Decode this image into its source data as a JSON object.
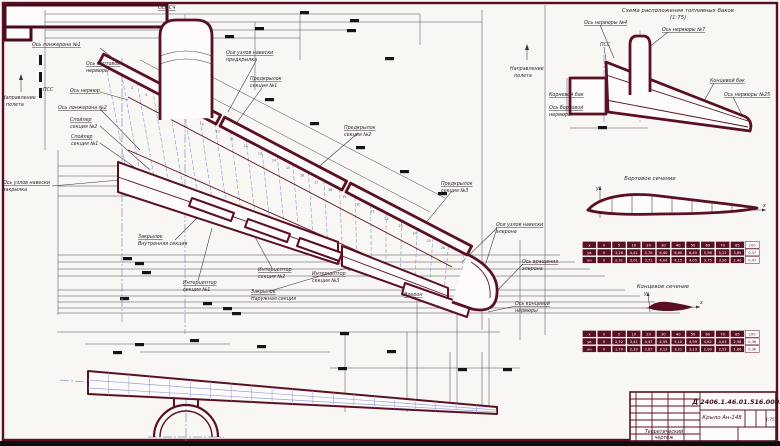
{
  "colors": {
    "line": "#5a1022",
    "ribs": "#9aa0d8",
    "dims": "#4a444a"
  },
  "plan": {
    "labels": {
      "os_sch": [
        "Ось СЧ"
      ],
      "napravlenie": [
        "Направление",
        "полета"
      ],
      "os_lonzherona_1": [
        "Ось лонжерона №1"
      ],
      "os_bortovoy_nervyury": [
        "Ось бортовой",
        "нервюры"
      ],
      "pss": [
        "ПСС"
      ],
      "os_nervyur": [
        "Ось нервюр"
      ],
      "os_lonzherona_2": [
        "Ось лонжерона №2"
      ],
      "spoiler_2": [
        "Спойлер",
        "секция №2"
      ],
      "spoiler_1": [
        "Спойлер",
        "секция №1"
      ],
      "os_uzlov_zakrylka": [
        "Ось узлов навески",
        "закрылка"
      ],
      "zakrylok_vnutr": [
        "Закрылок",
        "Внутренняя секция"
      ],
      "osi_uzlov_predkrylka": [
        "Оси узлов навески",
        "предкрылка"
      ],
      "predkrylok_1": [
        "Предкрылок",
        "секция №1"
      ],
      "predkrylok_2": [
        "Предкрылок",
        "секция №2"
      ],
      "predkrylok_3": [
        "Предкрылок",
        "секция №3"
      ],
      "interceptor_1": [
        "Интерцептор",
        "секция №1"
      ],
      "interceptor_2": [
        "Интерцептор",
        "секция №2"
      ],
      "interceptor_3": [
        "Интерцептор",
        "секция №3"
      ],
      "zakrylok_naruzh": [
        "Закрылок",
        "Наружная секция"
      ],
      "eleron": [
        "Элерон"
      ],
      "osi_uzlov_elerona": [
        "Оси узлов навески",
        "элерона"
      ],
      "os_vrashcheniya_elerona": [
        "Ось вращения",
        "элерона"
      ],
      "os_kontsevoy_nervyury": [
        "Ось концевой",
        "нервюры"
      ]
    },
    "rib_numbers": [
      "4",
      "5",
      "6",
      "7",
      "8",
      "9",
      "10",
      "11",
      "12",
      "13",
      "14",
      "15",
      "16",
      "17",
      "18",
      "19",
      "20",
      "21",
      "22",
      "23",
      "24",
      "25",
      "26"
    ]
  },
  "fuel_scheme": {
    "title": [
      "Схема расположения топливных баков",
      "(1:75)"
    ],
    "labels": {
      "os_nervyury_4": [
        "Ось нервюры №4"
      ],
      "pss": [
        "ПСС"
      ],
      "os_nervyury_7": [
        "Ось нервюры №7"
      ],
      "kornevoy_bak": [
        "Корневой бак"
      ],
      "os_bortovoy_nervyury": [
        "Ось бортовой",
        "нервюры"
      ],
      "kontsevoy_bak": [
        "Концевой бак"
      ],
      "os_nervyury_25": [
        "Ось нервюры №25"
      ]
    }
  },
  "sections": {
    "root": {
      "title": "Бортовое сечение",
      "axis_x": "x",
      "axis_y": "y",
      "table": {
        "rows": [
          [
            "x",
            "0",
            "5",
            "10",
            "20",
            "30",
            "40",
            "50",
            "60",
            "70",
            "85",
            "100"
          ],
          [
            "yв",
            "0",
            "3,26",
            "4,41",
            "5,78",
            "6,40",
            "6,60",
            "6,45",
            "5,98",
            "5,22",
            "3,85",
            "0,47"
          ],
          [
            "yн",
            "0",
            "2,31",
            "3,01",
            "3,71",
            "4,04",
            "4,15",
            "4,05",
            "3,75",
            "3,26",
            "2,40",
            "0,47"
          ]
        ]
      }
    },
    "tip": {
      "title": "Концевое сечение",
      "axis_x": "x",
      "axis_y": "y",
      "table": {
        "rows": [
          [
            "x",
            "0",
            "5",
            "10",
            "20",
            "30",
            "40",
            "50",
            "60",
            "70",
            "85",
            "100"
          ],
          [
            "yв",
            "0",
            "2,52",
            "3,41",
            "4,47",
            "4,95",
            "5,10",
            "4,99",
            "4,62",
            "4,03",
            "2,98",
            "0,36"
          ],
          [
            "yн",
            "0",
            "1,79",
            "2,33",
            "2,87",
            "3,12",
            "3,21",
            "3,13",
            "2,90",
            "2,52",
            "1,86",
            "0,36"
          ]
        ]
      }
    }
  },
  "title_block": {
    "doc_number": "Д 2406.1.46.01.516.0002",
    "part_name": "Крыло Ан-148",
    "doc_type": [
      "Теоретический",
      "чертеж"
    ],
    "scale": "1:75"
  }
}
